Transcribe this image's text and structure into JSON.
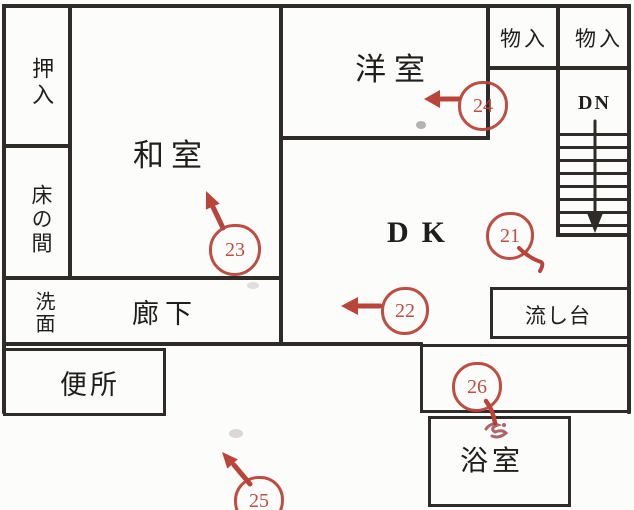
{
  "title": "floor-plan-scan",
  "colors": {
    "wall": "#2e2b28",
    "ink": "#201e1b",
    "annotation_red": "#b9453a",
    "paper": "#fcfcfa"
  },
  "rooms": {
    "oshiire": {
      "label": "押入"
    },
    "tokonoma": {
      "label": "床の間"
    },
    "washitsu": {
      "label": "和室"
    },
    "yoshitsu": {
      "label": "洋室"
    },
    "monoire_1": {
      "label": "物入"
    },
    "monoire_2": {
      "label": "物入"
    },
    "stairs": {
      "label": "DN"
    },
    "dk": {
      "label": "DK"
    },
    "senmen": {
      "label": "洗面"
    },
    "roka": {
      "label": "廊下"
    },
    "benjo": {
      "label": "便所"
    },
    "nagashidai": {
      "label": "流し台"
    },
    "yokushitsu": {
      "label": "浴室"
    }
  },
  "markers": {
    "m21": {
      "number": "21",
      "arrow": "tail-down-right"
    },
    "m22": {
      "number": "22",
      "arrow": "left"
    },
    "m23": {
      "number": "23",
      "arrow": "up-left"
    },
    "m24": {
      "number": "24",
      "arrow": "left"
    },
    "m25": {
      "number": "25",
      "arrow": "up-left"
    },
    "m26": {
      "number": "26",
      "arrow": "tail-down"
    }
  }
}
